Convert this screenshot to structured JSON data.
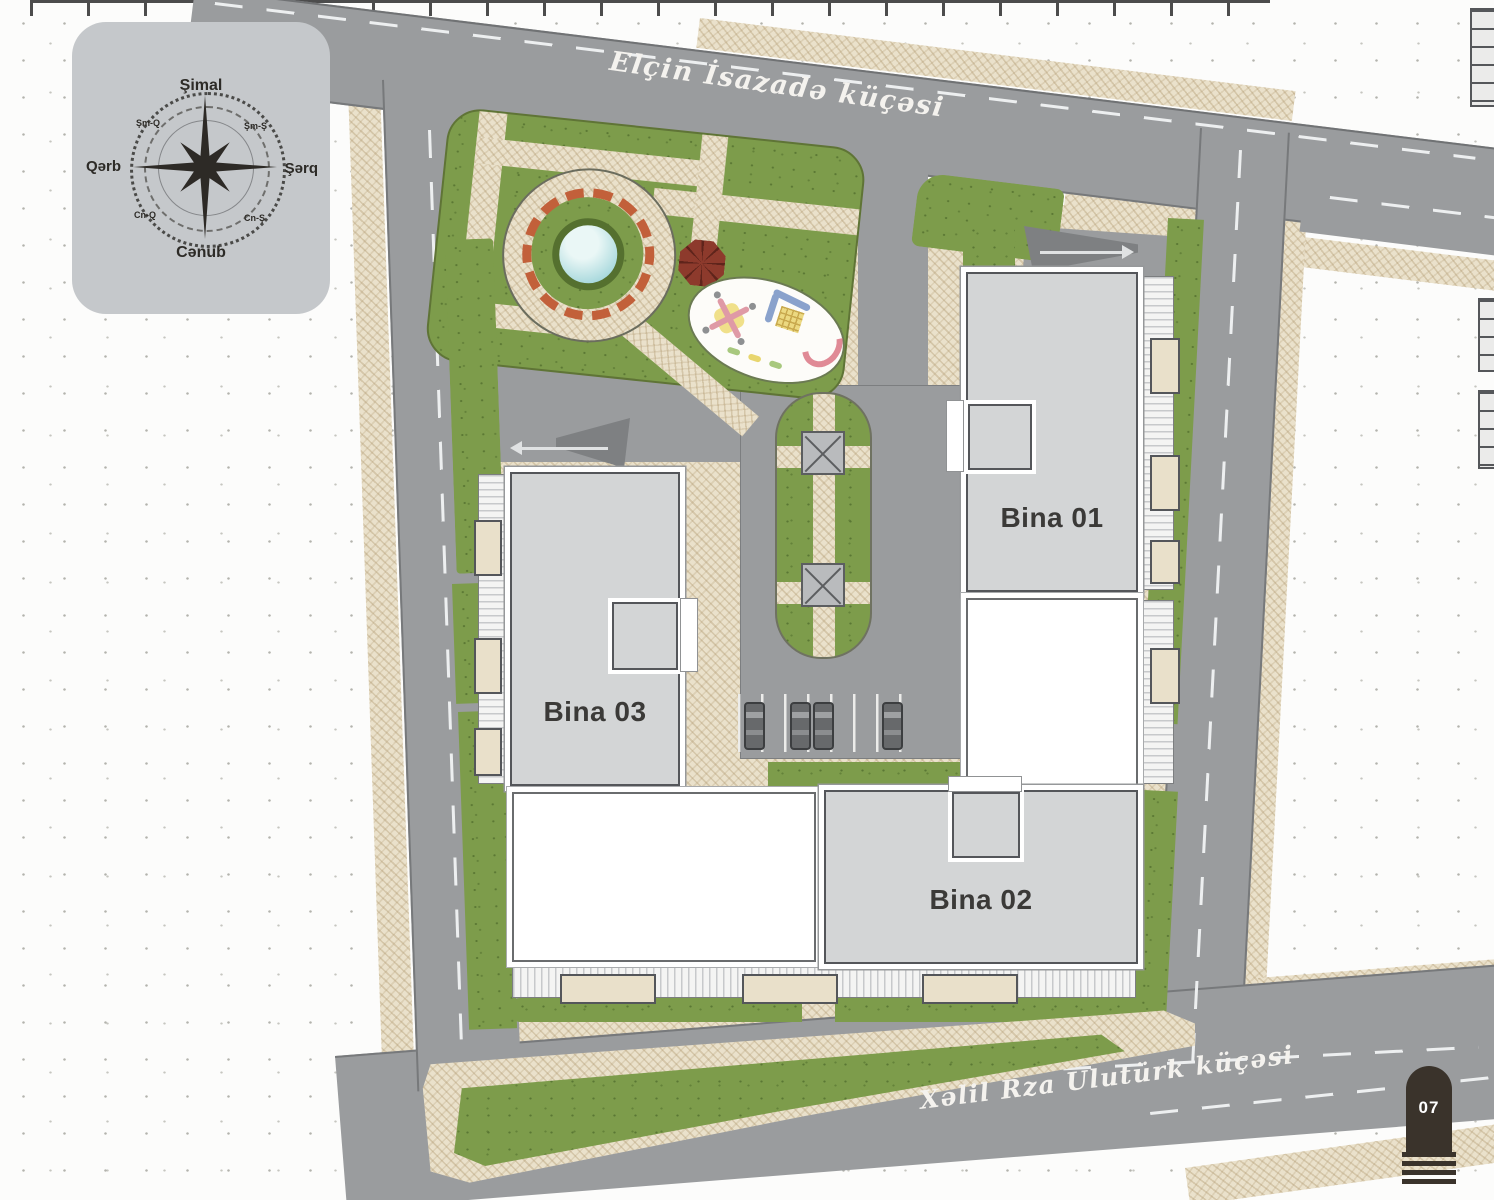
{
  "meta": {
    "title": "Yaşayış kompleksi baş planı",
    "plan_type": "site-master-plan"
  },
  "compass": {
    "north": "Şimal",
    "south": "Cənub",
    "west": "Qərb",
    "east": "Şərq",
    "north_west": "Şm-Q",
    "north_east": "Şm-Ş",
    "south_west": "Cn-Q",
    "south_east": "Cn-Ş"
  },
  "streets": {
    "north_street": "Elçin İsazadə küçəsi",
    "south_street": "Xəlil Rza Ulutürk küçəsi"
  },
  "buildings": {
    "bina01": "Bina 01",
    "bina02": "Bina 02",
    "bina03": "Bina 03"
  },
  "page_marker": "07",
  "parking": {
    "occupied_spaces": 4,
    "total_marked_spaces": 7
  },
  "colors": {
    "road": "#9a9c9e",
    "pavement": "#eae1cb",
    "grass": "#7d9c4b",
    "building_fill": "#d3d5d6",
    "building_border": "#54565a",
    "compass_panel": "#c5c8cb",
    "page_marker_bg": "#3a332b",
    "street_text": "#f4f2ee",
    "pool": "#9fd4d8",
    "gazebo": "#8d3a2c",
    "pergola": "#c2603a"
  },
  "icons": {
    "compass": "compass-rose-icon",
    "gazebo": "gazebo-icon",
    "pool": "pool-icon",
    "pavilion": "pavilion-icon",
    "car": "car-icon",
    "playground": [
      "carousel-icon",
      "climber-icon",
      "slide-icon",
      "seesaw-icon"
    ],
    "entry_arrow": "arrow-right-icon",
    "exit_arrow": "arrow-left-icon"
  }
}
